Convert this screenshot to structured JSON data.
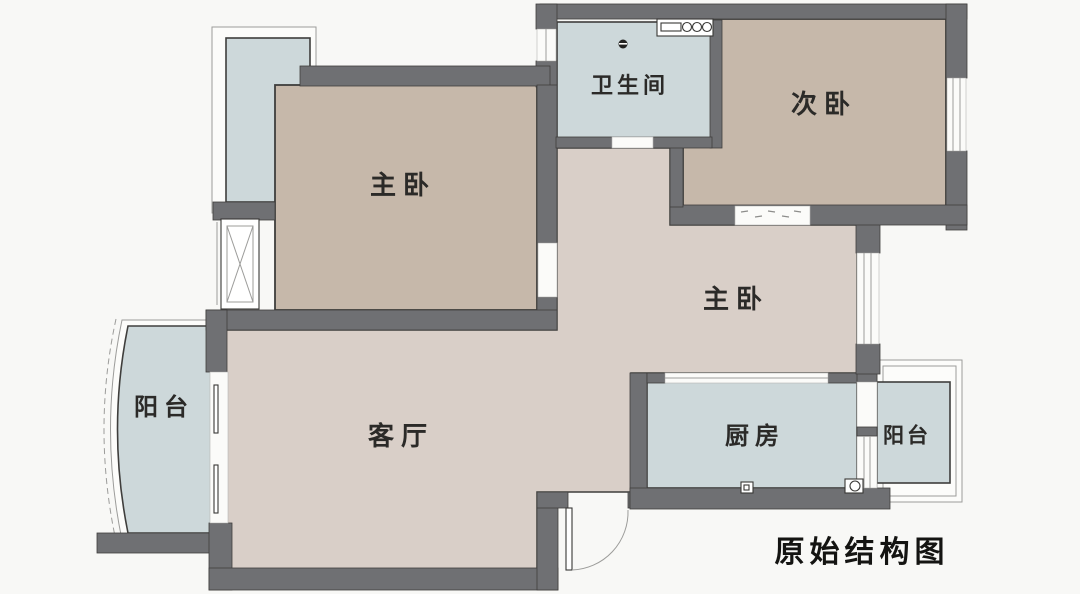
{
  "diagram": {
    "title": "原始结构图",
    "rooms": {
      "master_bedroom": "主卧",
      "bathroom": "卫生间",
      "second_bedroom": "次卧",
      "inner_master_bedroom": "主卧",
      "living_room": "客厅",
      "kitchen": "厨房",
      "balcony_left": "阳台",
      "balcony_right": "阳台"
    },
    "colors": {
      "bg": "#f8f8f6",
      "wall": "#6f7073",
      "bed": "#c6b8aa",
      "hall": "#d9cfc8",
      "wet": "#cdd8da",
      "frame": "#9c9c9a",
      "outline": "#3f3e3c",
      "ink": "#2b2a28"
    }
  }
}
